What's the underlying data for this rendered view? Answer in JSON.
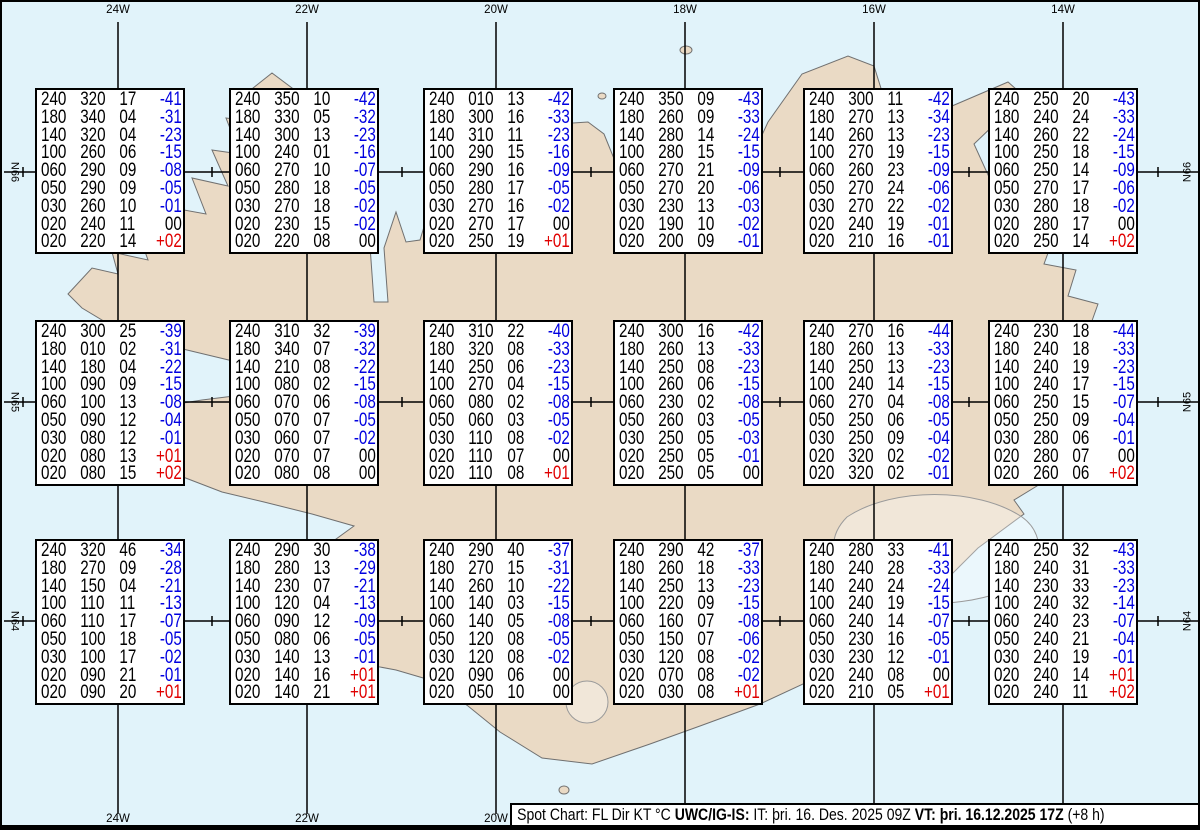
{
  "title": "Spot Chart UWC/IG-IS",
  "map": {
    "top_longitude_labels": [
      "24W",
      "22W",
      "20W",
      "18W",
      "16W",
      "14W"
    ],
    "bottom_longitude_labels": [
      "24W",
      "22W",
      "20W",
      "18W",
      "16W",
      "14W"
    ],
    "left_latitude_labels": [
      "N66",
      "N65",
      "N64"
    ],
    "right_latitude_labels": [
      "N66",
      "N65",
      "N64"
    ],
    "colors": {
      "ocean": "#e1f3fa",
      "land": "#eadac5",
      "coastline": "#707070",
      "glacier_outline": "#9a9a9a",
      "grid": "#000000",
      "temp_negative": "#0000e0",
      "temp_positive": "#e00000",
      "text": "#000000"
    }
  },
  "legend": {
    "columns": [
      "FL",
      "Dir",
      "KT",
      "°C"
    ]
  },
  "spot_boxes": [
    {
      "id": "r1c1",
      "rows": [
        [
          "240",
          "320",
          "17",
          "-41"
        ],
        [
          "180",
          "340",
          "04",
          "-31"
        ],
        [
          "140",
          "320",
          "04",
          "-23"
        ],
        [
          "100",
          "260",
          "06",
          "-15"
        ],
        [
          "060",
          "290",
          "09",
          "-08"
        ],
        [
          "050",
          "290",
          "09",
          "-05"
        ],
        [
          "030",
          "260",
          "10",
          "-01"
        ],
        [
          "020",
          "240",
          "11",
          "00"
        ],
        [
          "020",
          "220",
          "14",
          "+02"
        ]
      ]
    },
    {
      "id": "r1c2",
      "rows": [
        [
          "240",
          "350",
          "10",
          "-42"
        ],
        [
          "180",
          "330",
          "05",
          "-32"
        ],
        [
          "140",
          "300",
          "13",
          "-23"
        ],
        [
          "100",
          "240",
          "01",
          "-16"
        ],
        [
          "060",
          "270",
          "10",
          "-07"
        ],
        [
          "050",
          "280",
          "18",
          "-05"
        ],
        [
          "030",
          "270",
          "18",
          "-02"
        ],
        [
          "020",
          "230",
          "15",
          "-02"
        ],
        [
          "020",
          "220",
          "08",
          "00"
        ]
      ]
    },
    {
      "id": "r1c3",
      "rows": [
        [
          "240",
          "010",
          "13",
          "-42"
        ],
        [
          "180",
          "300",
          "16",
          "-33"
        ],
        [
          "140",
          "310",
          "11",
          "-23"
        ],
        [
          "100",
          "290",
          "15",
          "-16"
        ],
        [
          "060",
          "290",
          "16",
          "-09"
        ],
        [
          "050",
          "280",
          "17",
          "-05"
        ],
        [
          "030",
          "270",
          "16",
          "-02"
        ],
        [
          "020",
          "270",
          "17",
          "00"
        ],
        [
          "020",
          "250",
          "19",
          "+01"
        ]
      ]
    },
    {
      "id": "r1c4",
      "rows": [
        [
          "240",
          "350",
          "09",
          "-43"
        ],
        [
          "180",
          "260",
          "09",
          "-33"
        ],
        [
          "140",
          "280",
          "14",
          "-24"
        ],
        [
          "100",
          "280",
          "15",
          "-15"
        ],
        [
          "060",
          "270",
          "21",
          "-09"
        ],
        [
          "050",
          "270",
          "20",
          "-06"
        ],
        [
          "030",
          "230",
          "13",
          "-03"
        ],
        [
          "020",
          "190",
          "10",
          "-02"
        ],
        [
          "020",
          "200",
          "09",
          "-01"
        ]
      ]
    },
    {
      "id": "r1c5",
      "rows": [
        [
          "240",
          "300",
          "11",
          "-42"
        ],
        [
          "180",
          "270",
          "13",
          "-34"
        ],
        [
          "140",
          "260",
          "13",
          "-23"
        ],
        [
          "100",
          "270",
          "19",
          "-15"
        ],
        [
          "060",
          "260",
          "23",
          "-09"
        ],
        [
          "050",
          "270",
          "24",
          "-06"
        ],
        [
          "030",
          "270",
          "22",
          "-02"
        ],
        [
          "020",
          "240",
          "19",
          "-01"
        ],
        [
          "020",
          "210",
          "16",
          "-01"
        ]
      ]
    },
    {
      "id": "r1c6",
      "rows": [
        [
          "240",
          "250",
          "20",
          "-43"
        ],
        [
          "180",
          "240",
          "24",
          "-33"
        ],
        [
          "140",
          "260",
          "22",
          "-24"
        ],
        [
          "100",
          "250",
          "18",
          "-15"
        ],
        [
          "060",
          "250",
          "14",
          "-09"
        ],
        [
          "050",
          "270",
          "17",
          "-06"
        ],
        [
          "030",
          "280",
          "18",
          "-02"
        ],
        [
          "020",
          "280",
          "17",
          "00"
        ],
        [
          "020",
          "250",
          "14",
          "+02"
        ]
      ]
    },
    {
      "id": "r2c1",
      "rows": [
        [
          "240",
          "300",
          "25",
          "-39"
        ],
        [
          "180",
          "010",
          "02",
          "-31"
        ],
        [
          "140",
          "180",
          "04",
          "-22"
        ],
        [
          "100",
          "090",
          "09",
          "-15"
        ],
        [
          "060",
          "100",
          "13",
          "-08"
        ],
        [
          "050",
          "090",
          "12",
          "-04"
        ],
        [
          "030",
          "080",
          "12",
          "-01"
        ],
        [
          "020",
          "080",
          "13",
          "+01"
        ],
        [
          "020",
          "080",
          "15",
          "+02"
        ]
      ]
    },
    {
      "id": "r2c2",
      "rows": [
        [
          "240",
          "310",
          "32",
          "-39"
        ],
        [
          "180",
          "340",
          "07",
          "-32"
        ],
        [
          "140",
          "210",
          "08",
          "-22"
        ],
        [
          "100",
          "080",
          "02",
          "-15"
        ],
        [
          "060",
          "070",
          "06",
          "-08"
        ],
        [
          "050",
          "070",
          "07",
          "-05"
        ],
        [
          "030",
          "060",
          "07",
          "-02"
        ],
        [
          "020",
          "070",
          "07",
          "00"
        ],
        [
          "020",
          "080",
          "08",
          "00"
        ]
      ]
    },
    {
      "id": "r2c3",
      "rows": [
        [
          "240",
          "310",
          "22",
          "-40"
        ],
        [
          "180",
          "320",
          "08",
          "-33"
        ],
        [
          "140",
          "250",
          "06",
          "-23"
        ],
        [
          "100",
          "270",
          "04",
          "-15"
        ],
        [
          "060",
          "080",
          "02",
          "-08"
        ],
        [
          "050",
          "060",
          "03",
          "-05"
        ],
        [
          "030",
          "110",
          "08",
          "-02"
        ],
        [
          "020",
          "110",
          "07",
          "00"
        ],
        [
          "020",
          "110",
          "08",
          "+01"
        ]
      ]
    },
    {
      "id": "r2c4",
      "rows": [
        [
          "240",
          "300",
          "16",
          "-42"
        ],
        [
          "180",
          "260",
          "13",
          "-33"
        ],
        [
          "140",
          "250",
          "08",
          "-23"
        ],
        [
          "100",
          "260",
          "06",
          "-15"
        ],
        [
          "060",
          "230",
          "02",
          "-08"
        ],
        [
          "050",
          "260",
          "03",
          "-05"
        ],
        [
          "030",
          "250",
          "05",
          "-03"
        ],
        [
          "020",
          "250",
          "05",
          "-01"
        ],
        [
          "020",
          "250",
          "05",
          "00"
        ]
      ]
    },
    {
      "id": "r2c5",
      "rows": [
        [
          "240",
          "270",
          "16",
          "-44"
        ],
        [
          "180",
          "260",
          "13",
          "-33"
        ],
        [
          "140",
          "250",
          "13",
          "-23"
        ],
        [
          "100",
          "240",
          "14",
          "-15"
        ],
        [
          "060",
          "270",
          "04",
          "-08"
        ],
        [
          "050",
          "250",
          "06",
          "-05"
        ],
        [
          "030",
          "250",
          "09",
          "-04"
        ],
        [
          "020",
          "320",
          "02",
          "-02"
        ],
        [
          "020",
          "320",
          "02",
          "-01"
        ]
      ]
    },
    {
      "id": "r2c6",
      "rows": [
        [
          "240",
          "230",
          "18",
          "-44"
        ],
        [
          "180",
          "240",
          "18",
          "-33"
        ],
        [
          "140",
          "240",
          "19",
          "-23"
        ],
        [
          "100",
          "240",
          "17",
          "-15"
        ],
        [
          "060",
          "250",
          "15",
          "-07"
        ],
        [
          "050",
          "250",
          "09",
          "-04"
        ],
        [
          "030",
          "280",
          "06",
          "-01"
        ],
        [
          "020",
          "280",
          "07",
          "00"
        ],
        [
          "020",
          "260",
          "06",
          "+02"
        ]
      ]
    },
    {
      "id": "r3c1",
      "rows": [
        [
          "240",
          "320",
          "46",
          "-34"
        ],
        [
          "180",
          "270",
          "09",
          "-28"
        ],
        [
          "140",
          "150",
          "04",
          "-21"
        ],
        [
          "100",
          "110",
          "11",
          "-13"
        ],
        [
          "060",
          "110",
          "17",
          "-07"
        ],
        [
          "050",
          "100",
          "18",
          "-05"
        ],
        [
          "030",
          "100",
          "17",
          "-02"
        ],
        [
          "020",
          "090",
          "21",
          "-01"
        ],
        [
          "020",
          "090",
          "20",
          "+01"
        ]
      ]
    },
    {
      "id": "r3c2",
      "rows": [
        [
          "240",
          "290",
          "30",
          "-38"
        ],
        [
          "180",
          "280",
          "13",
          "-29"
        ],
        [
          "140",
          "230",
          "07",
          "-21"
        ],
        [
          "100",
          "120",
          "04",
          "-13"
        ],
        [
          "060",
          "090",
          "12",
          "-09"
        ],
        [
          "050",
          "080",
          "06",
          "-05"
        ],
        [
          "030",
          "140",
          "13",
          "-01"
        ],
        [
          "020",
          "140",
          "16",
          "+01"
        ],
        [
          "020",
          "140",
          "21",
          "+01"
        ]
      ]
    },
    {
      "id": "r3c3",
      "rows": [
        [
          "240",
          "290",
          "40",
          "-37"
        ],
        [
          "180",
          "270",
          "15",
          "-31"
        ],
        [
          "140",
          "260",
          "10",
          "-22"
        ],
        [
          "100",
          "140",
          "03",
          "-15"
        ],
        [
          "060",
          "140",
          "05",
          "-08"
        ],
        [
          "050",
          "120",
          "08",
          "-05"
        ],
        [
          "030",
          "120",
          "08",
          "-02"
        ],
        [
          "020",
          "090",
          "06",
          "00"
        ],
        [
          "020",
          "050",
          "10",
          "00"
        ]
      ]
    },
    {
      "id": "r3c4",
      "rows": [
        [
          "240",
          "290",
          "42",
          "-37"
        ],
        [
          "180",
          "260",
          "18",
          "-33"
        ],
        [
          "140",
          "250",
          "13",
          "-23"
        ],
        [
          "100",
          "220",
          "09",
          "-15"
        ],
        [
          "060",
          "160",
          "07",
          "-08"
        ],
        [
          "050",
          "150",
          "07",
          "-06"
        ],
        [
          "030",
          "120",
          "08",
          "-02"
        ],
        [
          "020",
          "070",
          "08",
          "-02"
        ],
        [
          "020",
          "030",
          "08",
          "+01"
        ]
      ]
    },
    {
      "id": "r3c5",
      "rows": [
        [
          "240",
          "280",
          "33",
          "-41"
        ],
        [
          "180",
          "240",
          "28",
          "-33"
        ],
        [
          "140",
          "240",
          "24",
          "-24"
        ],
        [
          "100",
          "240",
          "19",
          "-15"
        ],
        [
          "060",
          "240",
          "14",
          "-07"
        ],
        [
          "050",
          "230",
          "16",
          "-05"
        ],
        [
          "030",
          "230",
          "12",
          "-01"
        ],
        [
          "020",
          "240",
          "08",
          "00"
        ],
        [
          "020",
          "210",
          "05",
          "+01"
        ]
      ]
    },
    {
      "id": "r3c6",
      "rows": [
        [
          "240",
          "250",
          "32",
          "-43"
        ],
        [
          "180",
          "240",
          "31",
          "-33"
        ],
        [
          "140",
          "230",
          "33",
          "-23"
        ],
        [
          "100",
          "240",
          "32",
          "-14"
        ],
        [
          "060",
          "240",
          "23",
          "-07"
        ],
        [
          "050",
          "240",
          "21",
          "-04"
        ],
        [
          "030",
          "240",
          "19",
          "-01"
        ],
        [
          "020",
          "240",
          "14",
          "+01"
        ],
        [
          "020",
          "240",
          "11",
          "+02"
        ]
      ]
    }
  ],
  "footer": {
    "segments": [
      {
        "text": "Spot Chart: FL Dir KT °C ",
        "bold": false
      },
      {
        "text": "UWC/IG-IS:",
        "bold": true
      },
      {
        "text": " IT: þri. 16. Des. 2025 09Z ",
        "bold": false
      },
      {
        "text": "VT: þri. 16.12.2025 17Z",
        "bold": true
      },
      {
        "text": " (+8 h)",
        "bold": false
      }
    ]
  }
}
